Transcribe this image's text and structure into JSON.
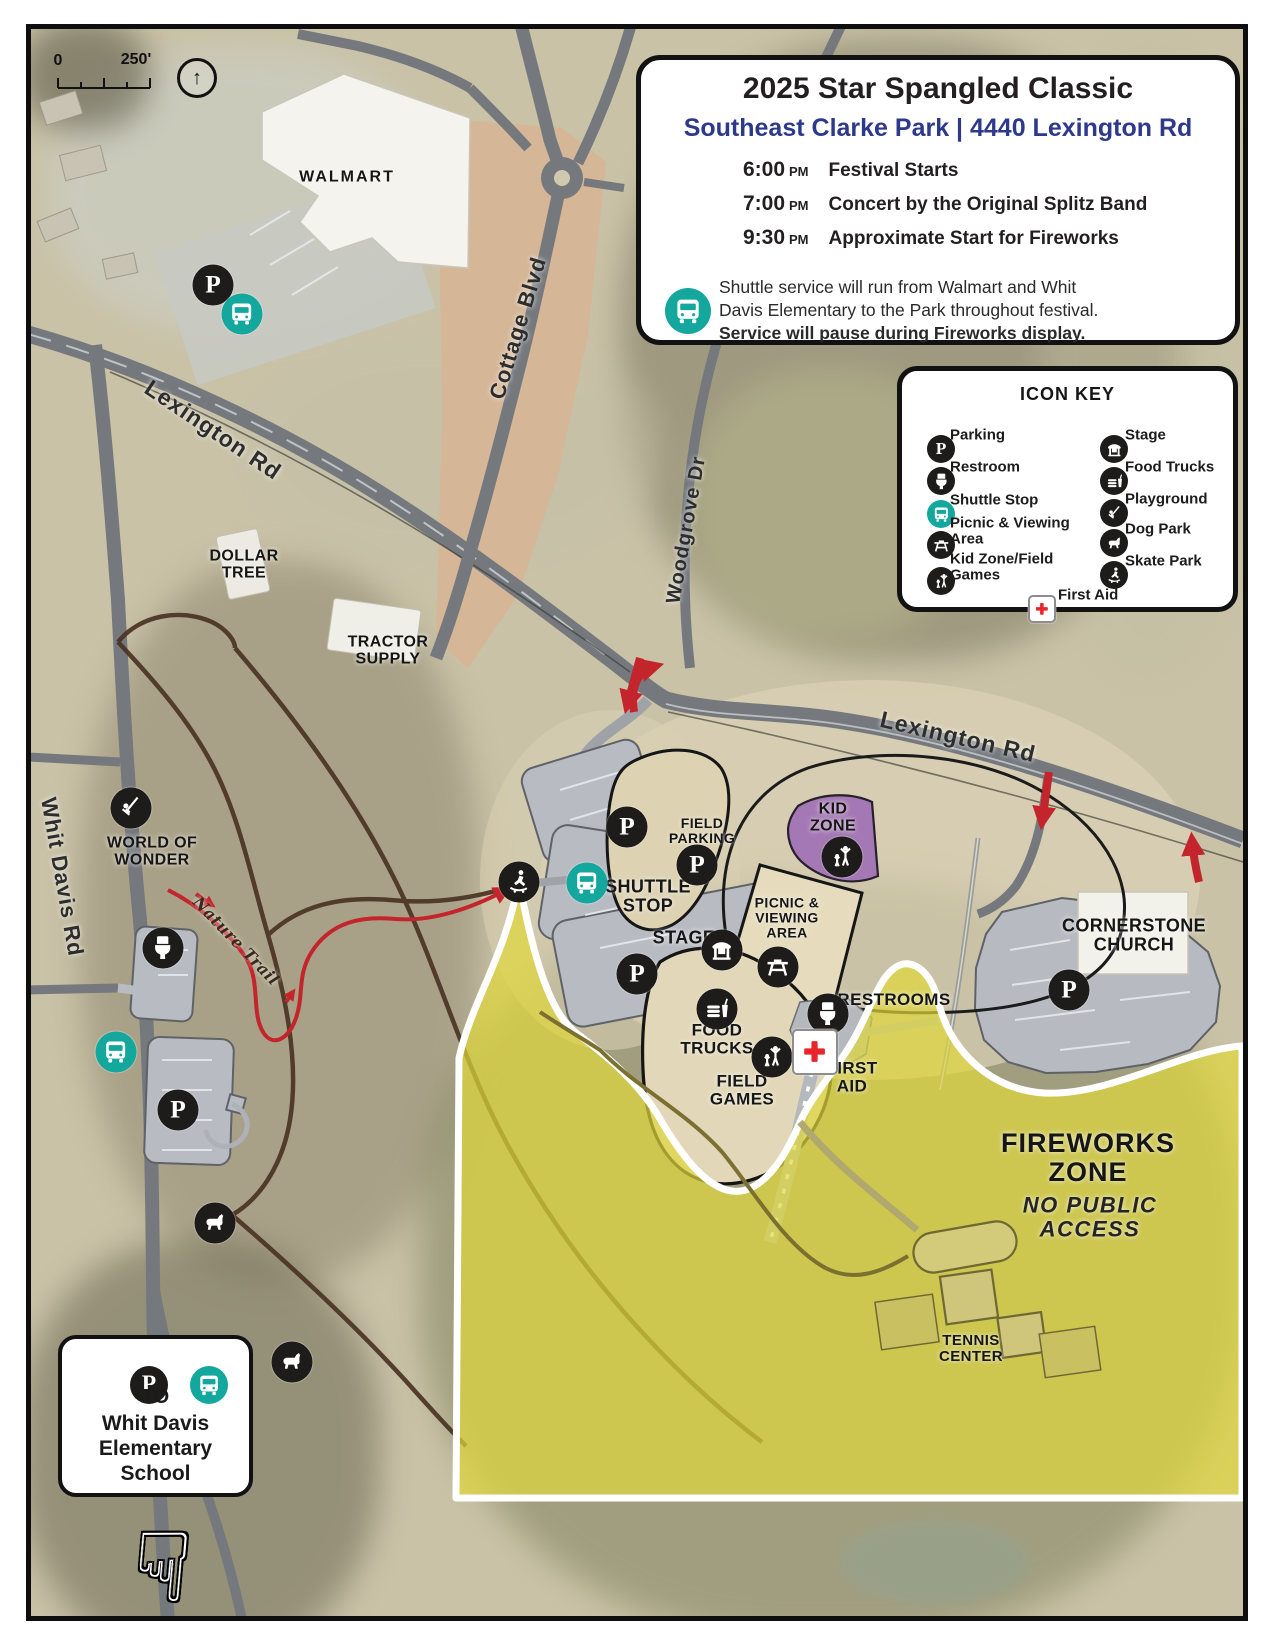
{
  "page_title": "2025 Star Spangled Classic Festival Map",
  "scale": {
    "zero": "0",
    "distance": "250'"
  },
  "title_box": {
    "title": "2025 Star Spangled Classic",
    "subtitle": "Southeast Clarke Park | 4440 Lexington Rd",
    "schedule": [
      {
        "time": "6:00",
        "period": "PM",
        "desc": "Festival Starts"
      },
      {
        "time": "7:00",
        "period": "PM",
        "desc": "Concert by the Original Splitz Band"
      },
      {
        "time": "9:30",
        "period": "PM",
        "desc": "Approximate Start for Fireworks"
      }
    ],
    "shuttle_note_lines": [
      "Shuttle service will run from Walmart and Whit",
      "Davis Elementary to the Park throughout festival."
    ],
    "shuttle_note_bold": "Service will pause during Fireworks display."
  },
  "icon_key": {
    "title": "ICON KEY",
    "left": [
      {
        "icon": "parking",
        "label": "Parking"
      },
      {
        "icon": "restroom",
        "label": "Restroom"
      },
      {
        "icon": "shuttle",
        "label": "Shuttle Stop"
      },
      {
        "icon": "picnic",
        "label": "Picnic & Viewing\nArea"
      },
      {
        "icon": "kid",
        "label": "Kid Zone/Field\nGames"
      }
    ],
    "right": [
      {
        "icon": "stage",
        "label": "Stage"
      },
      {
        "icon": "food",
        "label": "Food Trucks"
      },
      {
        "icon": "playground",
        "label": "Playground"
      },
      {
        "icon": "dog",
        "label": "Dog Park"
      },
      {
        "icon": "skate",
        "label": "Skate Park"
      }
    ],
    "first_aid": {
      "icon": "firstaid",
      "label": "First Aid"
    }
  },
  "sign": {
    "to_label": "TO",
    "name_lines": [
      "Whit Davis",
      "Elementary",
      "School"
    ]
  },
  "map": {
    "north_glyph": "↑",
    "hand_glyph": "☟",
    "labels": [
      {
        "id": "walmart",
        "t": "WALMART",
        "x": 347,
        "y": 177,
        "s": 16,
        "c": "ls"
      },
      {
        "id": "dollar-tree",
        "t": "DOLLAR\nTREE",
        "x": 244,
        "y": 565,
        "s": 16
      },
      {
        "id": "tractor-supply",
        "t": "TRACTOR\nSUPPLY",
        "x": 388,
        "y": 651,
        "s": 16
      },
      {
        "id": "lexington-rd-west",
        "t": "Lexington Rd",
        "x": 213,
        "y": 430,
        "r": 34,
        "s": 23,
        "c": "road"
      },
      {
        "id": "lexington-rd-east",
        "t": "Lexington Rd",
        "x": 958,
        "y": 737,
        "r": 13,
        "s": 23,
        "c": "road"
      },
      {
        "id": "cottage-blvd",
        "t": "Cottage Blvd",
        "x": 518,
        "y": 328,
        "r": -73,
        "s": 22,
        "c": "road"
      },
      {
        "id": "woodgrove-dr",
        "t": "Woodgrove Dr",
        "x": 687,
        "y": 530,
        "r": -80,
        "s": 20,
        "c": "road"
      },
      {
        "id": "whit-davis-rd",
        "t": "Whit Davis Rd",
        "x": 62,
        "y": 877,
        "r": 80,
        "s": 22,
        "c": "road"
      },
      {
        "id": "nature-trail",
        "t": "Nature Trail",
        "x": 236,
        "y": 941,
        "r": 46,
        "s": 16,
        "c": "trail"
      },
      {
        "id": "world-of-wonder",
        "t": "WORLD OF\nWONDER",
        "x": 152,
        "y": 852,
        "s": 16
      },
      {
        "id": "field-parking",
        "t": "FIELD\nPARKING",
        "x": 702,
        "y": 831,
        "s": 14
      },
      {
        "id": "kid-zone",
        "t": "KID\nZONE",
        "x": 833,
        "y": 818,
        "s": 16
      },
      {
        "id": "shuttle-stop",
        "t": "SHUTTLE\nSTOP",
        "x": 648,
        "y": 897,
        "s": 18
      },
      {
        "id": "stage",
        "t": "STAGE",
        "x": 684,
        "y": 938,
        "s": 18
      },
      {
        "id": "picnic-viewing-area",
        "t": "PICNIC &\nVIEWING\nAREA",
        "x": 787,
        "y": 918,
        "s": 14
      },
      {
        "id": "restrooms",
        "t": "RESTROOMS",
        "x": 894,
        "y": 1000,
        "s": 17
      },
      {
        "id": "food-trucks",
        "t": "FOOD\nTRUCKS",
        "x": 717,
        "y": 1040,
        "s": 17
      },
      {
        "id": "field-games",
        "t": "FIELD\nGAMES",
        "x": 742,
        "y": 1091,
        "s": 17
      },
      {
        "id": "first-aid",
        "t": "FIRST\nAID",
        "x": 852,
        "y": 1078,
        "s": 17
      },
      {
        "id": "cornerstone-church",
        "t": "CORNERSTONE\nCHURCH",
        "x": 1134,
        "y": 936,
        "s": 18
      },
      {
        "id": "fireworks-zone",
        "t": "FIREWORKS\nZONE",
        "x": 1088,
        "y": 1158,
        "s": 27,
        "c": "big"
      },
      {
        "id": "no-public-access",
        "t": "NO PUBLIC ACCESS",
        "x": 1090,
        "y": 1217,
        "s": 22,
        "c": "noaccess"
      },
      {
        "id": "tennis-center",
        "t": "TENNIS\nCENTER",
        "x": 971,
        "y": 1349,
        "s": 15
      }
    ],
    "badges": [
      {
        "t": "parking",
        "x": 213,
        "y": 285
      },
      {
        "t": "shuttle",
        "x": 242,
        "y": 314
      },
      {
        "t": "playground",
        "x": 131,
        "y": 808
      },
      {
        "t": "restroom",
        "x": 163,
        "y": 948
      },
      {
        "t": "shuttle",
        "x": 116,
        "y": 1052
      },
      {
        "t": "parking",
        "x": 178,
        "y": 1110
      },
      {
        "t": "dog",
        "x": 215,
        "y": 1223
      },
      {
        "t": "dog",
        "x": 292,
        "y": 1362
      },
      {
        "t": "parking",
        "x": 627,
        "y": 827
      },
      {
        "t": "parking",
        "x": 697,
        "y": 865
      },
      {
        "t": "parking",
        "x": 637,
        "y": 974
      },
      {
        "t": "shuttle",
        "x": 587,
        "y": 883
      },
      {
        "t": "skate",
        "x": 519,
        "y": 882
      },
      {
        "t": "stage",
        "x": 722,
        "y": 950
      },
      {
        "t": "picnic",
        "x": 778,
        "y": 967
      },
      {
        "t": "kid",
        "x": 842,
        "y": 857
      },
      {
        "t": "food",
        "x": 717,
        "y": 1009
      },
      {
        "t": "kid",
        "x": 772,
        "y": 1057
      },
      {
        "t": "restroom",
        "x": 828,
        "y": 1014
      },
      {
        "t": "firstaid",
        "x": 815,
        "y": 1052,
        "d": 46
      },
      {
        "t": "parking",
        "x": 1069,
        "y": 990
      }
    ]
  },
  "colors": {
    "shuttle_teal": "#14a79d",
    "heading_navy": "#2d3a8c",
    "route_red": "#c4242b",
    "fireworks_yellow": "#e0d73a",
    "kid_zone_purple": "#a478b4",
    "road_gray": "#75797e"
  }
}
